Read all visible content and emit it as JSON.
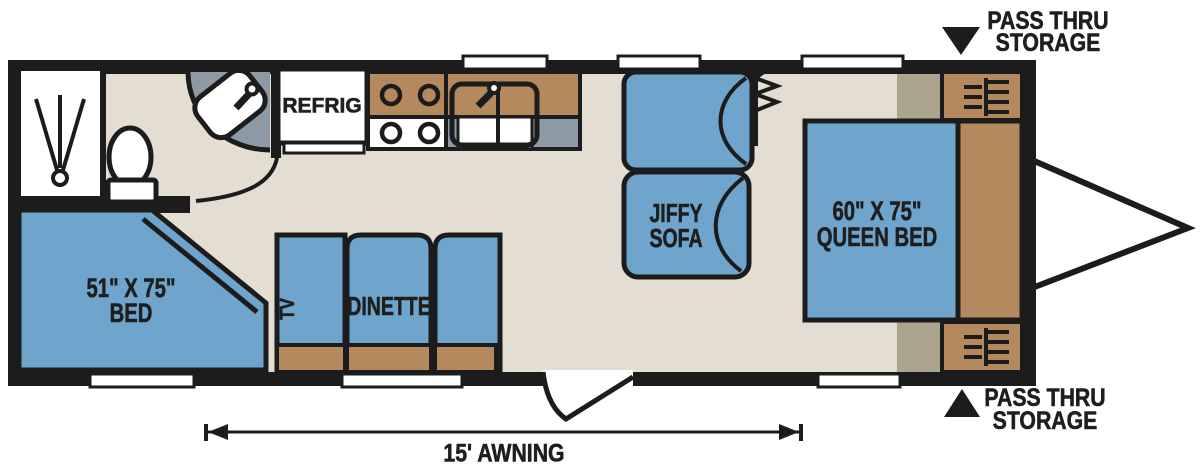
{
  "colors": {
    "wall": "#1c1c1c",
    "floor": "#e3ded1",
    "furniture_blue": "#6fa5cd",
    "cabinet_brown": "#b5895e",
    "counter_gray": "#8d99a4",
    "wardrobe_tan": "#aba590",
    "fixture_white": "#ffffff"
  },
  "labels": {
    "refrigerator": "REFRIG",
    "tv": "TV",
    "dinette": "DINETTE",
    "sofa_line1": "JIFFY",
    "sofa_line2": "SOFA",
    "rear_bed_line1": "51\" X 75\"",
    "rear_bed_line2": "BED",
    "queen_bed_line1": "60\" X 75\"",
    "queen_bed_line2": "QUEEN BED",
    "pass_thru_top_line1": "PASS THRU",
    "pass_thru_top_line2": "STORAGE",
    "pass_thru_bottom_line1": "PASS THRU",
    "pass_thru_bottom_line2": "STORAGE",
    "awning": "15' AWNING"
  }
}
